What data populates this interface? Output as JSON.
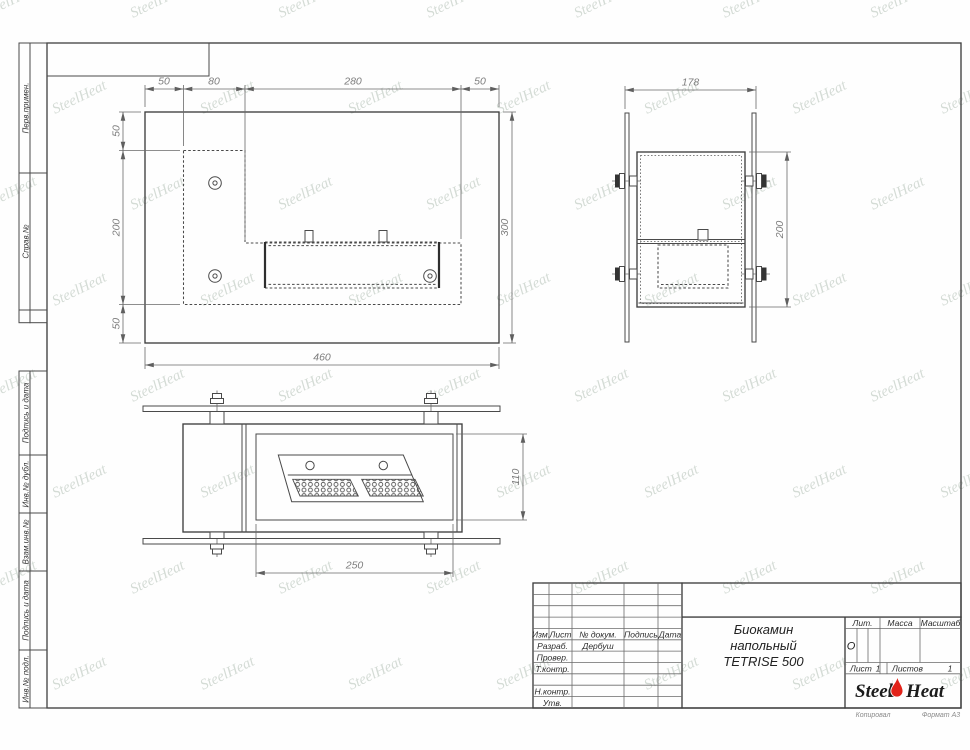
{
  "watermark": {
    "text": "SteelHeat"
  },
  "sidebar": {
    "labels": [
      "Перв.примен.",
      "Справ.№",
      "Подпись и дата",
      "Инв.№ дубл.",
      "Взам.инв.№",
      "Подпись и дата",
      "Инв.№ подл."
    ]
  },
  "top_view": {
    "dims_top": [
      "50",
      "80",
      "280",
      "50"
    ],
    "dims_left": [
      "50",
      "200",
      "50"
    ],
    "dim_bottom": "460",
    "dim_right": "300"
  },
  "side_view": {
    "dim_width": "178",
    "dim_height": "200"
  },
  "front_view": {
    "dim_bottom": "250",
    "dim_height": "110"
  },
  "title_block": {
    "col_izm": "Изм.",
    "col_list": "Лист",
    "col_doc": "№ докум.",
    "col_sign": "Подпись",
    "col_date": "Дата",
    "row_razrab": "Разраб.",
    "row_prover": "Провер.",
    "row_tkontr": "Т.контр.",
    "row_nkontr": "Н.контр.",
    "row_utv": "Утв.",
    "developer": "Дербуш",
    "title_line1": "Биокамин",
    "title_line2": "напольный",
    "title_line3": "TETRISE 500",
    "lit_label": "Лит.",
    "lit_value": "О",
    "mass_label": "Масса",
    "scale_label": "Масштаб",
    "sheet_label": "Лист",
    "sheet_num": "1",
    "sheets_label": "Листов",
    "sheets_num": "1",
    "logo_steel": "Steel",
    "logo_heat": "Heat",
    "copied": "Копировал",
    "format": "Формат А3"
  }
}
